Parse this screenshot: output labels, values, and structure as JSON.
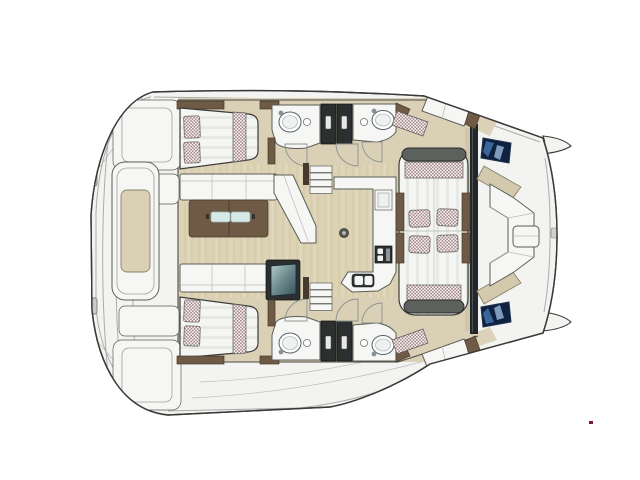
{
  "page": {
    "background": "#ffffff",
    "content_type": "yacht floor plan",
    "vessel": "sailing catamaran",
    "view": "top-down interior deck layout, bow facing right"
  },
  "colors": {
    "hull": "#f3f4f1",
    "outline": "#3a3a38",
    "seam": "#a9aea9",
    "deck": "#d9d0b5",
    "deck2": "#d3c9ad",
    "wood": "#dcd2b4",
    "woodgrain": "#ccc1a0",
    "white": "#f6f7f4",
    "stroke1": "#5c5c58",
    "brown": "#6e5a45",
    "browndark": "#463a2d",
    "chk": "#a28484",
    "chkbg": "#fcfbfb",
    "glass": "#d6e9e9",
    "teal1": "#b7cccb",
    "teal2": "#35525a",
    "navy": "#0e2240",
    "blue1": "#3f6ea6",
    "blue2": "#8fb0d4",
    "cap": "#5c615e",
    "dark": "#2c2f30",
    "red": "#7a2025",
    "stripe": "#e6e9e5",
    "stripebg": "#f5f6f3"
  },
  "features": [
    {
      "name": "hull-outline"
    },
    {
      "name": "bow-tips"
    },
    {
      "name": "stern-swim-platform"
    },
    {
      "name": "aft-cockpit-table"
    },
    {
      "name": "port-aft-berth"
    },
    {
      "name": "starboard-aft-berth"
    },
    {
      "name": "checkered-pillows"
    },
    {
      "name": "saloon-sofa-port"
    },
    {
      "name": "saloon-sofa-starboard"
    },
    {
      "name": "saloon-coffee-table"
    },
    {
      "name": "media-cabinet"
    },
    {
      "name": "port-head-vanity"
    },
    {
      "name": "starboard-head-vanity"
    },
    {
      "name": "head-sliding-doors"
    },
    {
      "name": "door-swing-arcs"
    },
    {
      "name": "companionway-steps-port"
    },
    {
      "name": "companionway-steps-starboard"
    },
    {
      "name": "galley-counter"
    },
    {
      "name": "cooktop"
    },
    {
      "name": "double-sink"
    },
    {
      "name": "saloon-windshield"
    },
    {
      "name": "double-sun-lounger"
    },
    {
      "name": "lounger-cushions"
    },
    {
      "name": "side-deck-bench-port"
    },
    {
      "name": "side-deck-bench-starboard"
    },
    {
      "name": "foredeck-hatch-port"
    },
    {
      "name": "foredeck-hatch-starboard"
    },
    {
      "name": "foredeck-u-sofa"
    },
    {
      "name": "foredeck-table"
    },
    {
      "name": "floor-mounting-ring"
    },
    {
      "name": "artifact-dot"
    }
  ]
}
